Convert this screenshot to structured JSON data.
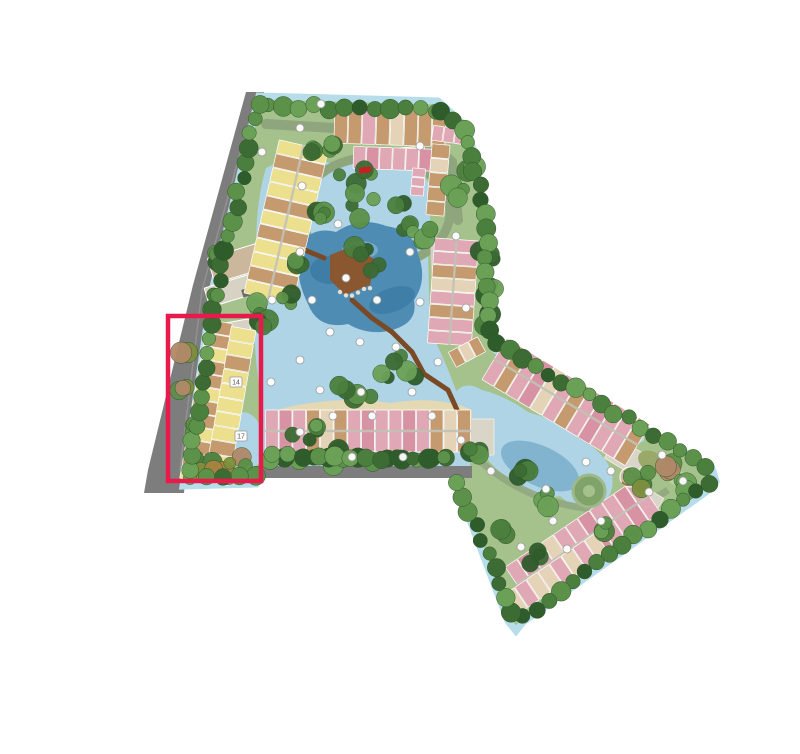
{
  "app": {
    "name": "resort-site-plan-view",
    "background": "#ffffff"
  },
  "site_plan": {
    "type": "master-plan-illustration",
    "highlight": {
      "name": "selected-block",
      "x": 168,
      "y": 316,
      "width": 93,
      "height": 165,
      "stroke_width": 4.5,
      "color": "#e8194b"
    },
    "markers": {
      "labeled": [
        {
          "label": "14",
          "x": 236,
          "y": 382
        },
        {
          "label": "17",
          "x": 241,
          "y": 436
        }
      ],
      "dots": [
        [
          321,
          104
        ],
        [
          300,
          128
        ],
        [
          420,
          146
        ],
        [
          262,
          152
        ],
        [
          302,
          186
        ],
        [
          338,
          224
        ],
        [
          300,
          252
        ],
        [
          410,
          252
        ],
        [
          456,
          236
        ],
        [
          272,
          300
        ],
        [
          312,
          300
        ],
        [
          346,
          278
        ],
        [
          377,
          300
        ],
        [
          420,
          302
        ],
        [
          330,
          332
        ],
        [
          360,
          342
        ],
        [
          396,
          347
        ],
        [
          438,
          362
        ],
        [
          300,
          360
        ],
        [
          271,
          382
        ],
        [
          320,
          390
        ],
        [
          361,
          392
        ],
        [
          412,
          392
        ],
        [
          300,
          432
        ],
        [
          333,
          416
        ],
        [
          372,
          416
        ],
        [
          432,
          416
        ],
        [
          352,
          457
        ],
        [
          403,
          457
        ],
        [
          461,
          440
        ],
        [
          491,
          471
        ],
        [
          546,
          489
        ],
        [
          521,
          547
        ],
        [
          553,
          521
        ],
        [
          586,
          462
        ],
        [
          611,
          471
        ],
        [
          649,
          492
        ],
        [
          567,
          549
        ],
        [
          601,
          521
        ],
        [
          662,
          455
        ],
        [
          683,
          481
        ],
        [
          466,
          308
        ]
      ]
    },
    "palette": {
      "site_green": "#a5c28c",
      "lawn_light": "#b9d3a0",
      "water_light": "#aed4e6",
      "water_edge": "#b7dcea",
      "lagoon": "#4e8cb4",
      "lagoon_dark": "#3b7aa3",
      "lagoon_glint": "#7fb3d4",
      "road_gray": "#7d7d7d",
      "road_sage": "#8fa57d",
      "path_light": "#cfcfc4",
      "spine_gray": "#c2c2b6",
      "plaza_gray": "#d9d6c9",
      "bldg_yellow": "#ecdf8e",
      "bldg_tan": "#c59a6e",
      "bldg_pink": "#dfa8b4",
      "bldg_rose": "#d793a4",
      "bldg_cream": "#e5d3b8",
      "bldg_gray": "#d8d2c4",
      "clubhouse_tan": "#cbb79b",
      "structure_dark": "#6b6b62",
      "court_green": "#aece8d",
      "deck_brown": "#8a5730",
      "bridge_brown": "#7a4a26",
      "sand": "#e8d9b0",
      "pond_olive": "#9aa86a",
      "car_red": "#c42222",
      "marker_fill": "#ffffff",
      "marker_stroke": "#9a9a9a",
      "marker_text": "#555555",
      "tree_colors": [
        "#3c6b33",
        "#4b7f3e",
        "#5b9149",
        "#6aa156",
        "#2f5c2b"
      ],
      "shrub_colors": [
        "#7d8f3e",
        "#a8833f",
        "#b08968",
        "#4b7f3e",
        "#5b9149"
      ]
    },
    "buildings": {
      "rows": {
        "northwest-terraces": [
          "bldg_yellow",
          "bldg_tan",
          "bldg_yellow",
          "bldg_yellow",
          "bldg_tan",
          "bldg_yellow",
          "bldg_tan",
          "bldg_yellow"
        ],
        "north-row": [
          "bldg_tan",
          "bldg_tan",
          "bldg_pink",
          "bldg_tan",
          "bldg_cream",
          "bldg_tan"
        ],
        "north-inner-row": [
          "bldg_pink",
          "bldg_rose",
          "bldg_pink",
          "bldg_pink"
        ],
        "northeast-pocket": [
          "bldg_pink",
          "bldg_pink"
        ],
        "northeast-column": [
          "bldg_tan",
          "bldg_cream",
          "bldg_tan",
          "bldg_tan"
        ],
        "northeast-pink": [
          "bldg_pink",
          "bldg_pink"
        ],
        "east-column": [
          "bldg_pink",
          "bldg_pink",
          "bldg_tan",
          "bldg_cream",
          "bldg_pink",
          "bldg_tan",
          "bldg_pink"
        ],
        "east-foot-blocks": [
          "bldg_tan",
          "bldg_cream"
        ],
        "wedge-upper-row": [
          "bldg_pink",
          "bldg_tan",
          "bldg_pink",
          "bldg_rose",
          "bldg_cream",
          "bldg_pink",
          "bldg_tan",
          "bldg_pink",
          "bldg_rose",
          "bldg_pink"
        ],
        "wedge-lower-row": [
          "bldg_pink",
          "bldg_rose",
          "bldg_pink",
          "bldg_cream",
          "bldg_pink",
          "bldg_pink",
          "bldg_rose",
          "bldg_pink"
        ],
        "wedge-tip-row": [
          "bldg_cream",
          "bldg_pink",
          "bldg_cream",
          "bldg_cream",
          "bldg_pink"
        ],
        "south-row": [
          "bldg_pink",
          "bldg_rose",
          "bldg_pink",
          "bldg_tan",
          "bldg_cream",
          "bldg_tan",
          "bldg_pink",
          "bldg_rose",
          "bldg_pink"
        ],
        "selected-west-row": [
          "bldg_tan",
          "bldg_tan",
          "bldg_yellow",
          "bldg_tan",
          "bldg_tan",
          "bldg_yellow"
        ],
        "selected-east-row": [
          "bldg_yellow",
          "bldg_yellow",
          "bldg_tan",
          "bldg_yellow",
          "bldg_yellow",
          "bldg_yellow"
        ]
      }
    }
  }
}
